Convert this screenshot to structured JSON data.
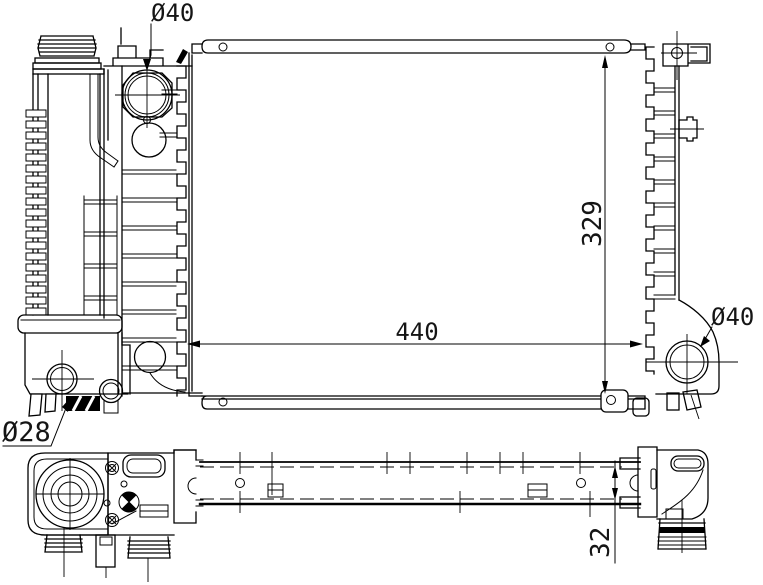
{
  "annotations": {
    "top_inlet_diameter": {
      "label": "Ø40"
    },
    "right_outlet_diameter": {
      "label": "Ø40"
    },
    "bottom_hose_diameter": {
      "label": "Ø28"
    },
    "core_width": {
      "label": "440"
    },
    "core_height": {
      "label": "329"
    },
    "core_depth": {
      "label": "32"
    }
  },
  "colors": {
    "line": "#000000",
    "background": "#ffffff",
    "text": "#151515"
  }
}
